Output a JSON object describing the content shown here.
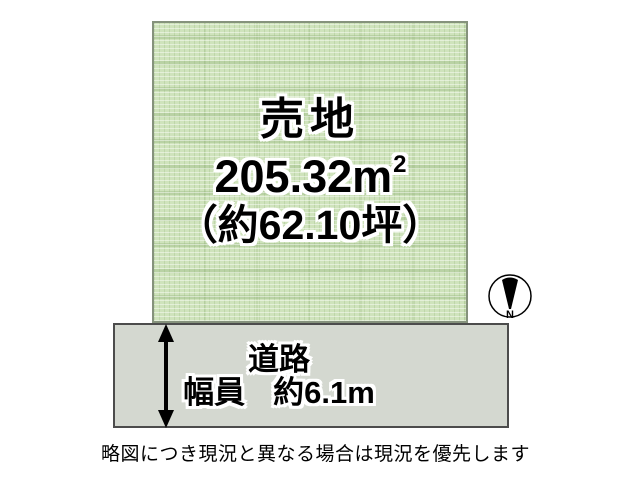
{
  "diagram": {
    "plot": {
      "title": "売地",
      "area_value": "205.32",
      "area_unit": "m",
      "area_exponent": "2",
      "tsubo_label": "（約62.10坪）"
    },
    "road": {
      "name": "道路",
      "width_label": "幅員",
      "width_value": "約6.1m"
    },
    "compass": {
      "north_label": "N"
    },
    "caption": "略図につき現況と異なる場合は現況を優先します",
    "colors": {
      "plot_fill": "#cfe3bc",
      "plot_border": "#85927c",
      "road_fill": "#d4d8d0",
      "road_border": "#4c4c4c",
      "text": "#000000",
      "text_outline": "#ffffff",
      "compass_needle": "#000000"
    }
  }
}
